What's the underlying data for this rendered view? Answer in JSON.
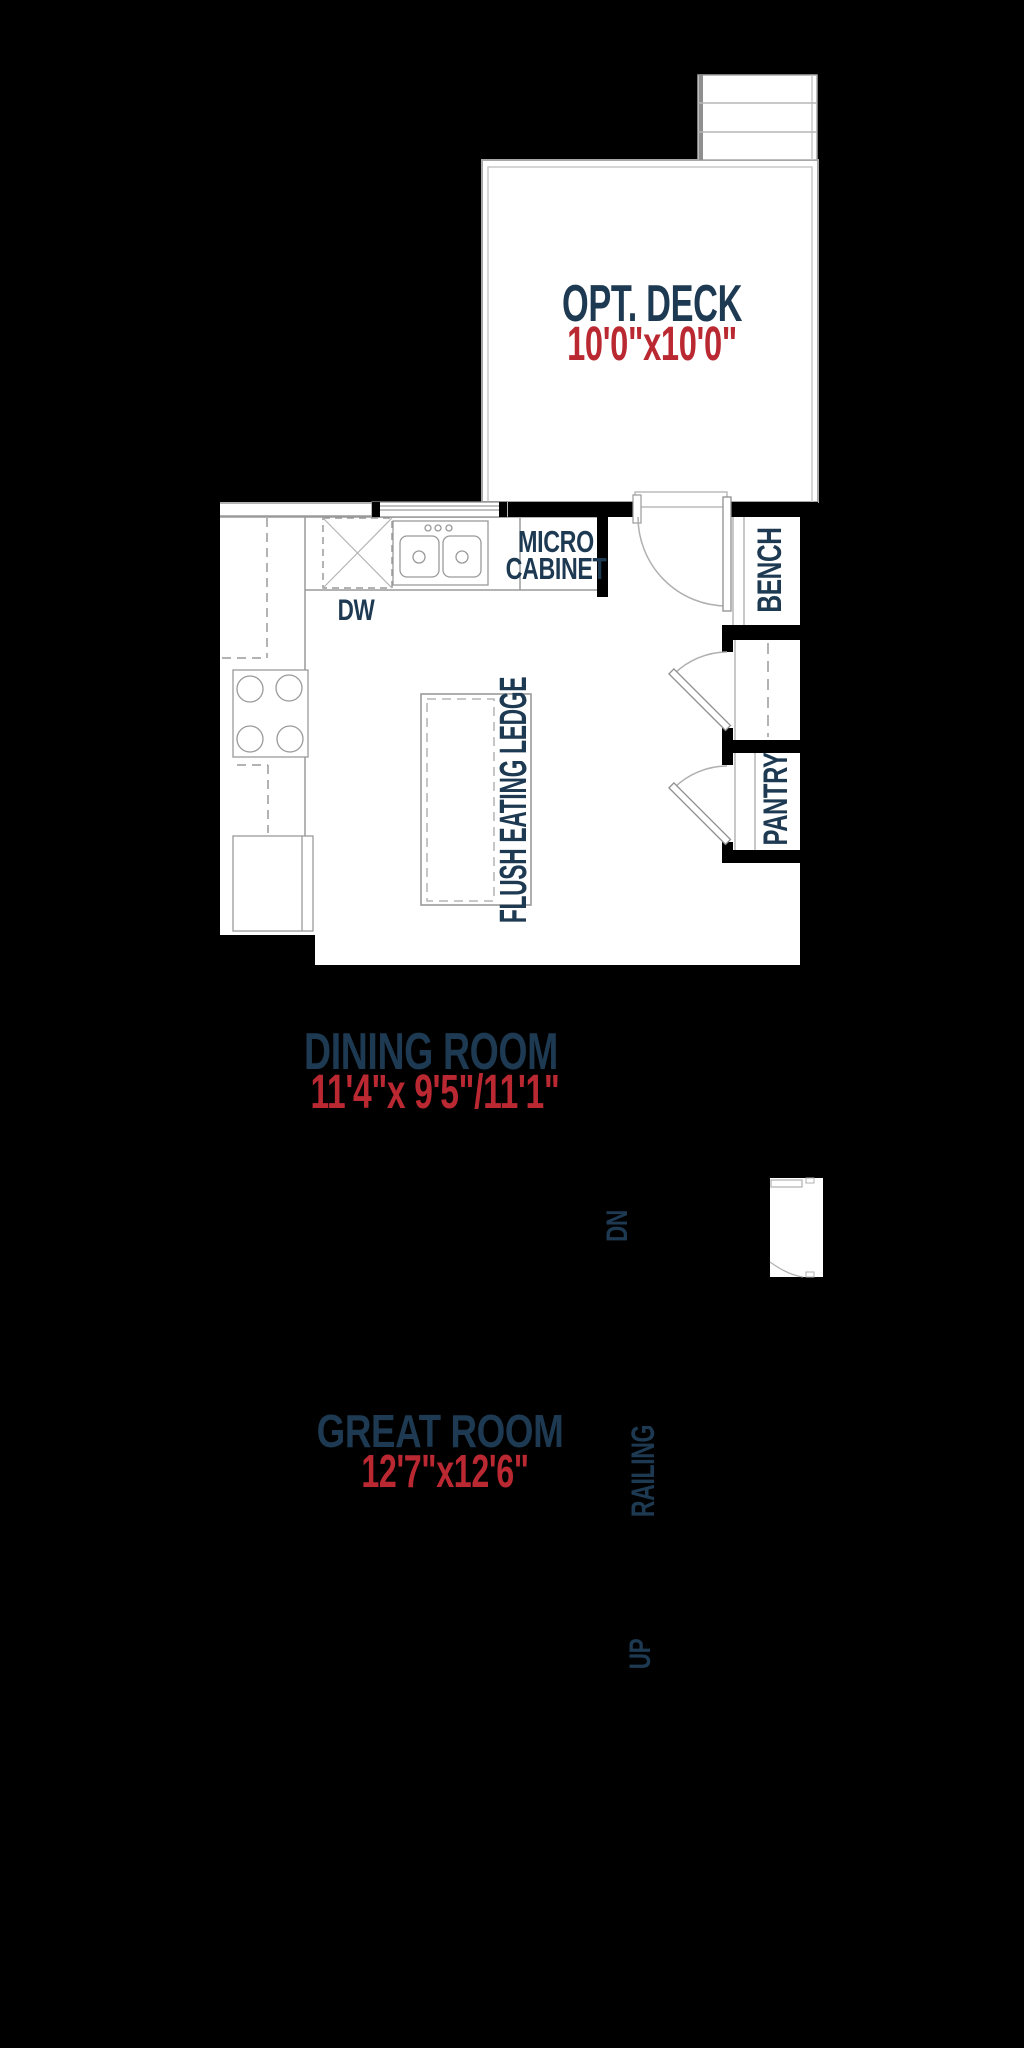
{
  "colors": {
    "background": "#000000",
    "floor": "#ffffff",
    "wall": "#000000",
    "line_gray": "#9a9a9a",
    "label_navy": "#1d3a52",
    "dimension_red": "#ba2832"
  },
  "plan": {
    "deck": {
      "label": "OPT. DECK",
      "dimensions": "10'0\"x10'0\""
    },
    "kitchen": {
      "dishwasher_label": "DW",
      "micro_cabinet_line1": "MICRO",
      "micro_cabinet_line2": "CABINET",
      "island_label": "FLUSH EATING LEDGE",
      "bench_label": "BENCH",
      "pantry_label": "PANTRY"
    },
    "dining_room": {
      "label": "DINING ROOM",
      "dimensions": "11'4\"x 9'5\"/11'1\""
    },
    "great_room": {
      "label": "GREAT ROOM",
      "dimensions": "12'7\"x12'6\""
    },
    "stairs": {
      "down_label": "DN",
      "up_label": "UP",
      "railing_label": "RAILING"
    }
  }
}
